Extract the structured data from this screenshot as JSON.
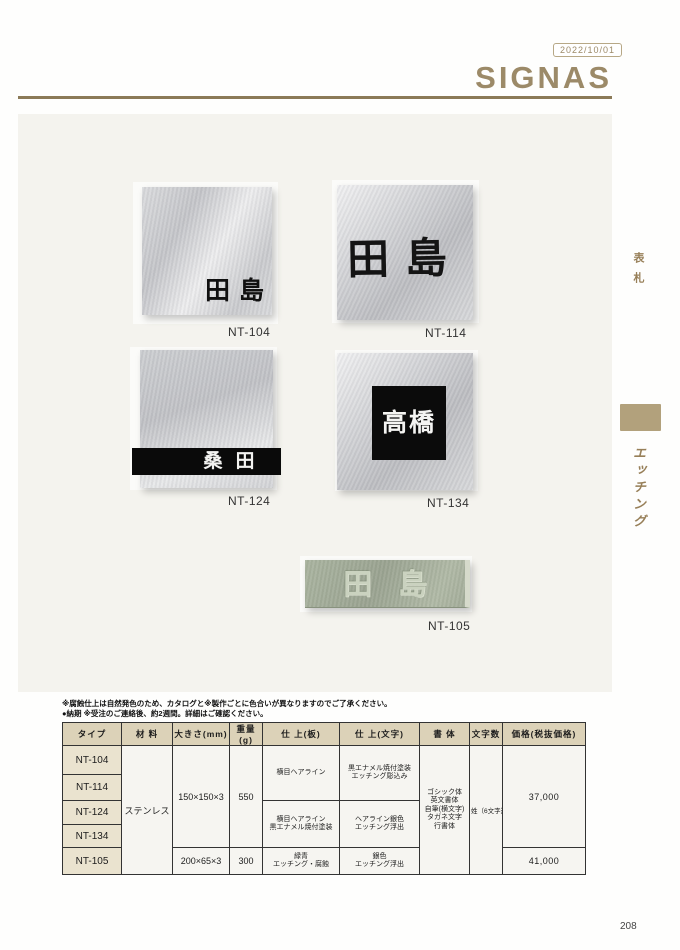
{
  "header": {
    "date_badge": "2022/10/01",
    "brand": "SIGNAS"
  },
  "sidebar": {
    "category_top": "表札",
    "category_current": "エッチング"
  },
  "products": [
    {
      "id": "NT-104",
      "name": "田島"
    },
    {
      "id": "NT-114",
      "name": "田島"
    },
    {
      "id": "NT-124",
      "name": "桑田"
    },
    {
      "id": "NT-134",
      "name": "高橋"
    },
    {
      "id": "NT-105",
      "name": "田島"
    }
  ],
  "notes": {
    "line1": "※腐蝕仕上は自然発色のため、カタログと※製作ごとに色合いが異なりますのでご了承ください。",
    "line2": "●納期 ※受注のご連絡後、約2週間。詳細はご確認ください。"
  },
  "table": {
    "headers": [
      "タイプ",
      "材 料",
      "大きさ(mm)",
      "重量(g)",
      "仕 上(板)",
      "仕 上(文字)",
      "書 体",
      "文字数",
      "価格(税抜価格)"
    ],
    "rows_types": [
      "NT-104",
      "NT-114",
      "NT-124",
      "NT-134",
      "NT-105"
    ],
    "material": "ステンレス",
    "size_104_134": "150×150×3",
    "size_105": "200×65×3",
    "weight_104_134": "550",
    "weight_105": "300",
    "finish_plate_104_114": "横目ヘアライン",
    "finish_plate_124_134": {
      "line1": "横目ヘアライン",
      "line2": "黒エナメル焼付塗装"
    },
    "finish_plate_105": {
      "line1": "緑青",
      "line2": "エッチング・腐蝕"
    },
    "finish_text_104_114": {
      "line1": "黒エナメル焼付塗装",
      "line2": "エッチング彫込み"
    },
    "finish_text_124_134": {
      "line1": "ヘアライン銀色",
      "line2": "エッチング浮出"
    },
    "finish_text_105": {
      "line1": "銀色",
      "line2": "エッチング浮出"
    },
    "typeface_lines": [
      "ゴシック体",
      "英文書体",
      "自筆(横文字)",
      "タガネ文字",
      "行書体"
    ],
    "char_count": "姓（6文字迄）",
    "price_104_134": "37,000",
    "price_105": "41,000"
  },
  "page_number": "208",
  "colors": {
    "brand": "#9c8a68",
    "rule": "#8b7a57",
    "sidebar_tab": "#b2a17c",
    "table_header_bg": "#dcd2b8",
    "panel_bg": "#f4f3ee",
    "plate_green": "#a3ad99"
  }
}
